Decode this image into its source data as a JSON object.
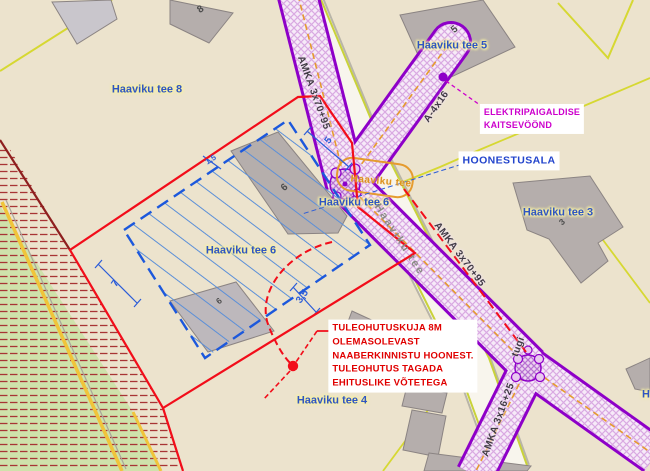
{
  "map": {
    "addresses": [
      "Haaviku tee 8",
      "Haaviku tee 5",
      "Haaviku tee 3",
      "Haaviku tee 6",
      "Haaviku tee 4"
    ],
    "road_name": "Haaviku tee",
    "colors": {
      "background_land": "#ece3cd",
      "green_land": "#cfe2ab",
      "protection_zone_border": "#8e00c8",
      "cable_line_orange": "#e59b2e",
      "parcel_boundary_red": "#f20d1a",
      "building_envelope_blue": "#1c58dc",
      "fire_safety_text_red": "#e00000",
      "note_magenta": "#cc00cc",
      "building_gray": "#b5aeac",
      "boundary_yellow": "#d6d832"
    }
  },
  "labels": [
    {
      "name": "address-haaviku-tee-8",
      "text": "Haaviku tee 8",
      "cx": 147,
      "cy": 90,
      "rot": 0,
      "cls": "addr"
    },
    {
      "name": "address-haaviku-tee-5",
      "text": "Haaviku tee 5",
      "cx": 452,
      "cy": 46,
      "rot": 0,
      "cls": "addr"
    },
    {
      "name": "address-haaviku-tee-3",
      "text": "Haaviku tee 3",
      "cx": 558,
      "cy": 213,
      "rot": 0,
      "cls": "addr"
    },
    {
      "name": "address-haaviku-tee-6",
      "text": "Haaviku tee 6",
      "cx": 354,
      "cy": 203,
      "rot": 0,
      "cls": "addr"
    },
    {
      "name": "address-haaviku-tee-6-second",
      "text": "Haaviku tee 6",
      "cx": 241,
      "cy": 251,
      "rot": 0,
      "cls": "addr"
    },
    {
      "name": "address-haaviku-tee-4",
      "text": "Haaviku tee 4",
      "cx": 332,
      "cy": 401,
      "rot": 0,
      "cls": "addr"
    },
    {
      "name": "address-clipped-right-edge",
      "text": "H",
      "cx": 646,
      "cy": 395,
      "rot": 0,
      "cls": "addr"
    },
    {
      "name": "road-name-label-junction",
      "text": "Haaviku tee",
      "cx": 381,
      "cy": 182,
      "rot": 5,
      "cls": "road-orange"
    },
    {
      "name": "road-name-label-along-road",
      "text": "Haaviku tee",
      "cx": 399,
      "cy": 240,
      "rot": 57,
      "cls": "road-gray"
    },
    {
      "name": "cable-label-amka-3x70-95-north",
      "text": "AMKA 3x70+95",
      "cx": 313,
      "cy": 93,
      "rot": 70,
      "cls": "cable"
    },
    {
      "name": "cable-label-amka-3x70-95-south",
      "text": "AMKA 3x70+95",
      "cx": 459,
      "cy": 255,
      "rot": 53,
      "cls": "cable"
    },
    {
      "name": "cable-label-a-4x16",
      "text": "A-4x16",
      "cx": 437,
      "cy": 107,
      "rot": -55,
      "cls": "cable"
    },
    {
      "name": "cable-label-amka-3x16-25",
      "text": "AMKA 3x16+25",
      "cx": 499,
      "cy": 420,
      "rot": -70,
      "cls": "cable"
    },
    {
      "name": "pole-label-tugi",
      "text": "tugi",
      "cx": 519,
      "cy": 347,
      "rot": -70,
      "cls": "cable"
    },
    {
      "name": "dimension-5",
      "text": "5",
      "cx": 329,
      "cy": 141,
      "rot": -52,
      "cls": "dim"
    },
    {
      "name": "dimension-7",
      "text": "7",
      "cx": 116,
      "cy": 284,
      "rot": -55,
      "cls": "dim"
    },
    {
      "name": "dimension-3-5",
      "text": "3,5",
      "cx": 303,
      "cy": 297,
      "rot": -55,
      "cls": "dim"
    },
    {
      "name": "dimension-1-5",
      "text": "1,5",
      "cx": 211,
      "cy": 160,
      "rot": -33,
      "cls": "dim dim-sm"
    },
    {
      "name": "building-number-8",
      "text": "8",
      "cx": 201,
      "cy": 10,
      "rot": -35,
      "cls": "bno"
    },
    {
      "name": "building-number-5",
      "text": "5",
      "cx": 455,
      "cy": 30,
      "rot": -40,
      "cls": "bno"
    },
    {
      "name": "building-number-6",
      "text": "6",
      "cx": 285,
      "cy": 188,
      "rot": -40,
      "cls": "bno"
    },
    {
      "name": "building-number-6b",
      "text": "6",
      "cx": 219,
      "cy": 301,
      "rot": -40,
      "cls": "bno bno-sm"
    },
    {
      "name": "building-number-3",
      "text": "3",
      "cx": 562,
      "cy": 222,
      "rot": -40,
      "cls": "bno bno-sm"
    }
  ],
  "notes": [
    {
      "name": "note-elektripaigaldise-kaitsevoond",
      "lines": [
        "ELEKTRIPAIGALDISE",
        "KAITSEVÖÖND"
      ],
      "cx": 532,
      "cy": 119,
      "cls": "note-magenta"
    },
    {
      "name": "note-hoonestusala",
      "lines": [
        "HOONESTUSALA"
      ],
      "cx": 509,
      "cy": 161,
      "cls": "note-blue"
    },
    {
      "name": "note-tuleohutus",
      "lines": [
        "TULEOHUTUSKUJA 8M",
        "OLEMASOLEVAST",
        "NAABERKINNISTU HOONEST.",
        "TULEOHUTUS TAGADA",
        "EHITUSLIKE VÕTETEGA"
      ],
      "cx": 403,
      "cy": 356,
      "cls": "note-red"
    }
  ]
}
